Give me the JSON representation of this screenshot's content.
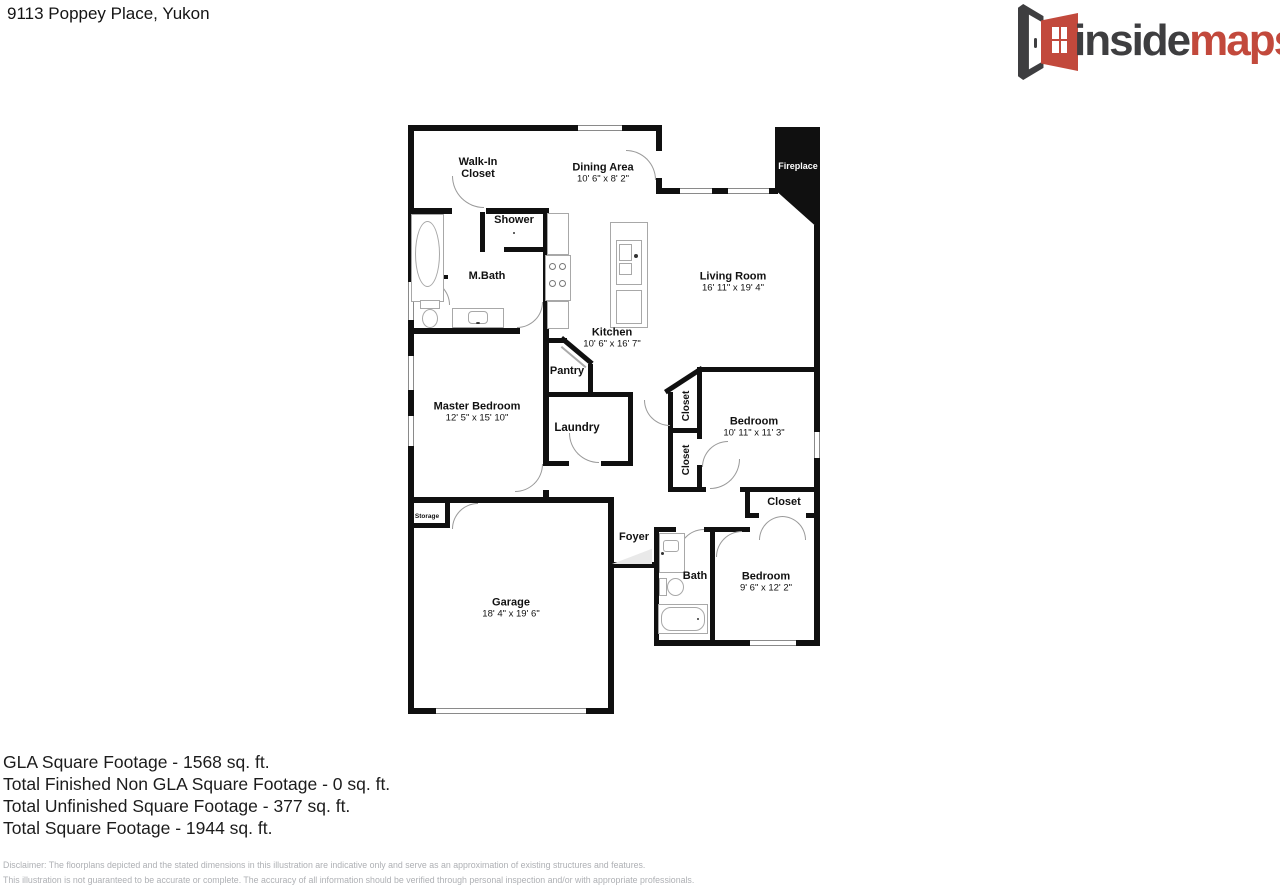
{
  "header": {
    "address": "9113 Poppey Place, Yukon"
  },
  "logo": {
    "brand_dark": "inside",
    "brand_accent": "maps",
    "dark_color": "#3e3e40",
    "accent_color": "#c2493c",
    "icon": "open-door-icon"
  },
  "rooms": {
    "walk_in_closet": {
      "name": "Walk-In Closet"
    },
    "dining_area": {
      "name": "Dining Area",
      "dims": "10' 6\" x 8' 2\""
    },
    "fireplace": {
      "name": "Fireplace"
    },
    "living_room": {
      "name": "Living Room",
      "dims": "16' 11\" x 19' 4\""
    },
    "shower": {
      "name": "Shower"
    },
    "m_bath": {
      "name": "M.Bath"
    },
    "kitchen": {
      "name": "Kitchen",
      "dims": "10' 6\" x 16' 7\""
    },
    "pantry": {
      "name": "Pantry"
    },
    "laundry": {
      "name": "Laundry"
    },
    "master_bedroom": {
      "name": "Master Bedroom",
      "dims": "12' 5\" x 15' 10\""
    },
    "closet_a": {
      "name": "Closet"
    },
    "closet_b": {
      "name": "Closet"
    },
    "bedroom_1": {
      "name": "Bedroom",
      "dims": "10' 11\" x 11' 3\""
    },
    "closet_c": {
      "name": "Closet"
    },
    "foyer": {
      "name": "Foyer"
    },
    "bath": {
      "name": "Bath"
    },
    "bedroom_2": {
      "name": "Bedroom",
      "dims": "9' 6\" x 12' 2\""
    },
    "garage": {
      "name": "Garage",
      "dims": "18' 4\" x 19' 6\""
    },
    "storage": {
      "name": "Storage"
    }
  },
  "summary": {
    "lines": [
      "GLA Square Footage - 1568 sq. ft.",
      "Total Finished Non GLA Square Footage - 0 sq. ft.",
      "Total Unfinished Square Footage - 377 sq. ft.",
      "Total Square Footage - 1944 sq. ft."
    ]
  },
  "disclaimer": {
    "line1": "Disclaimer: The floorplans depicted and the stated dimensions in this illustration are indicative only and serve as an approximation of existing structures and features.",
    "line2": "This illustration is not guaranteed to be accurate or complete. The accuracy of all information should be verified through personal inspection and/or with appropriate professionals."
  }
}
